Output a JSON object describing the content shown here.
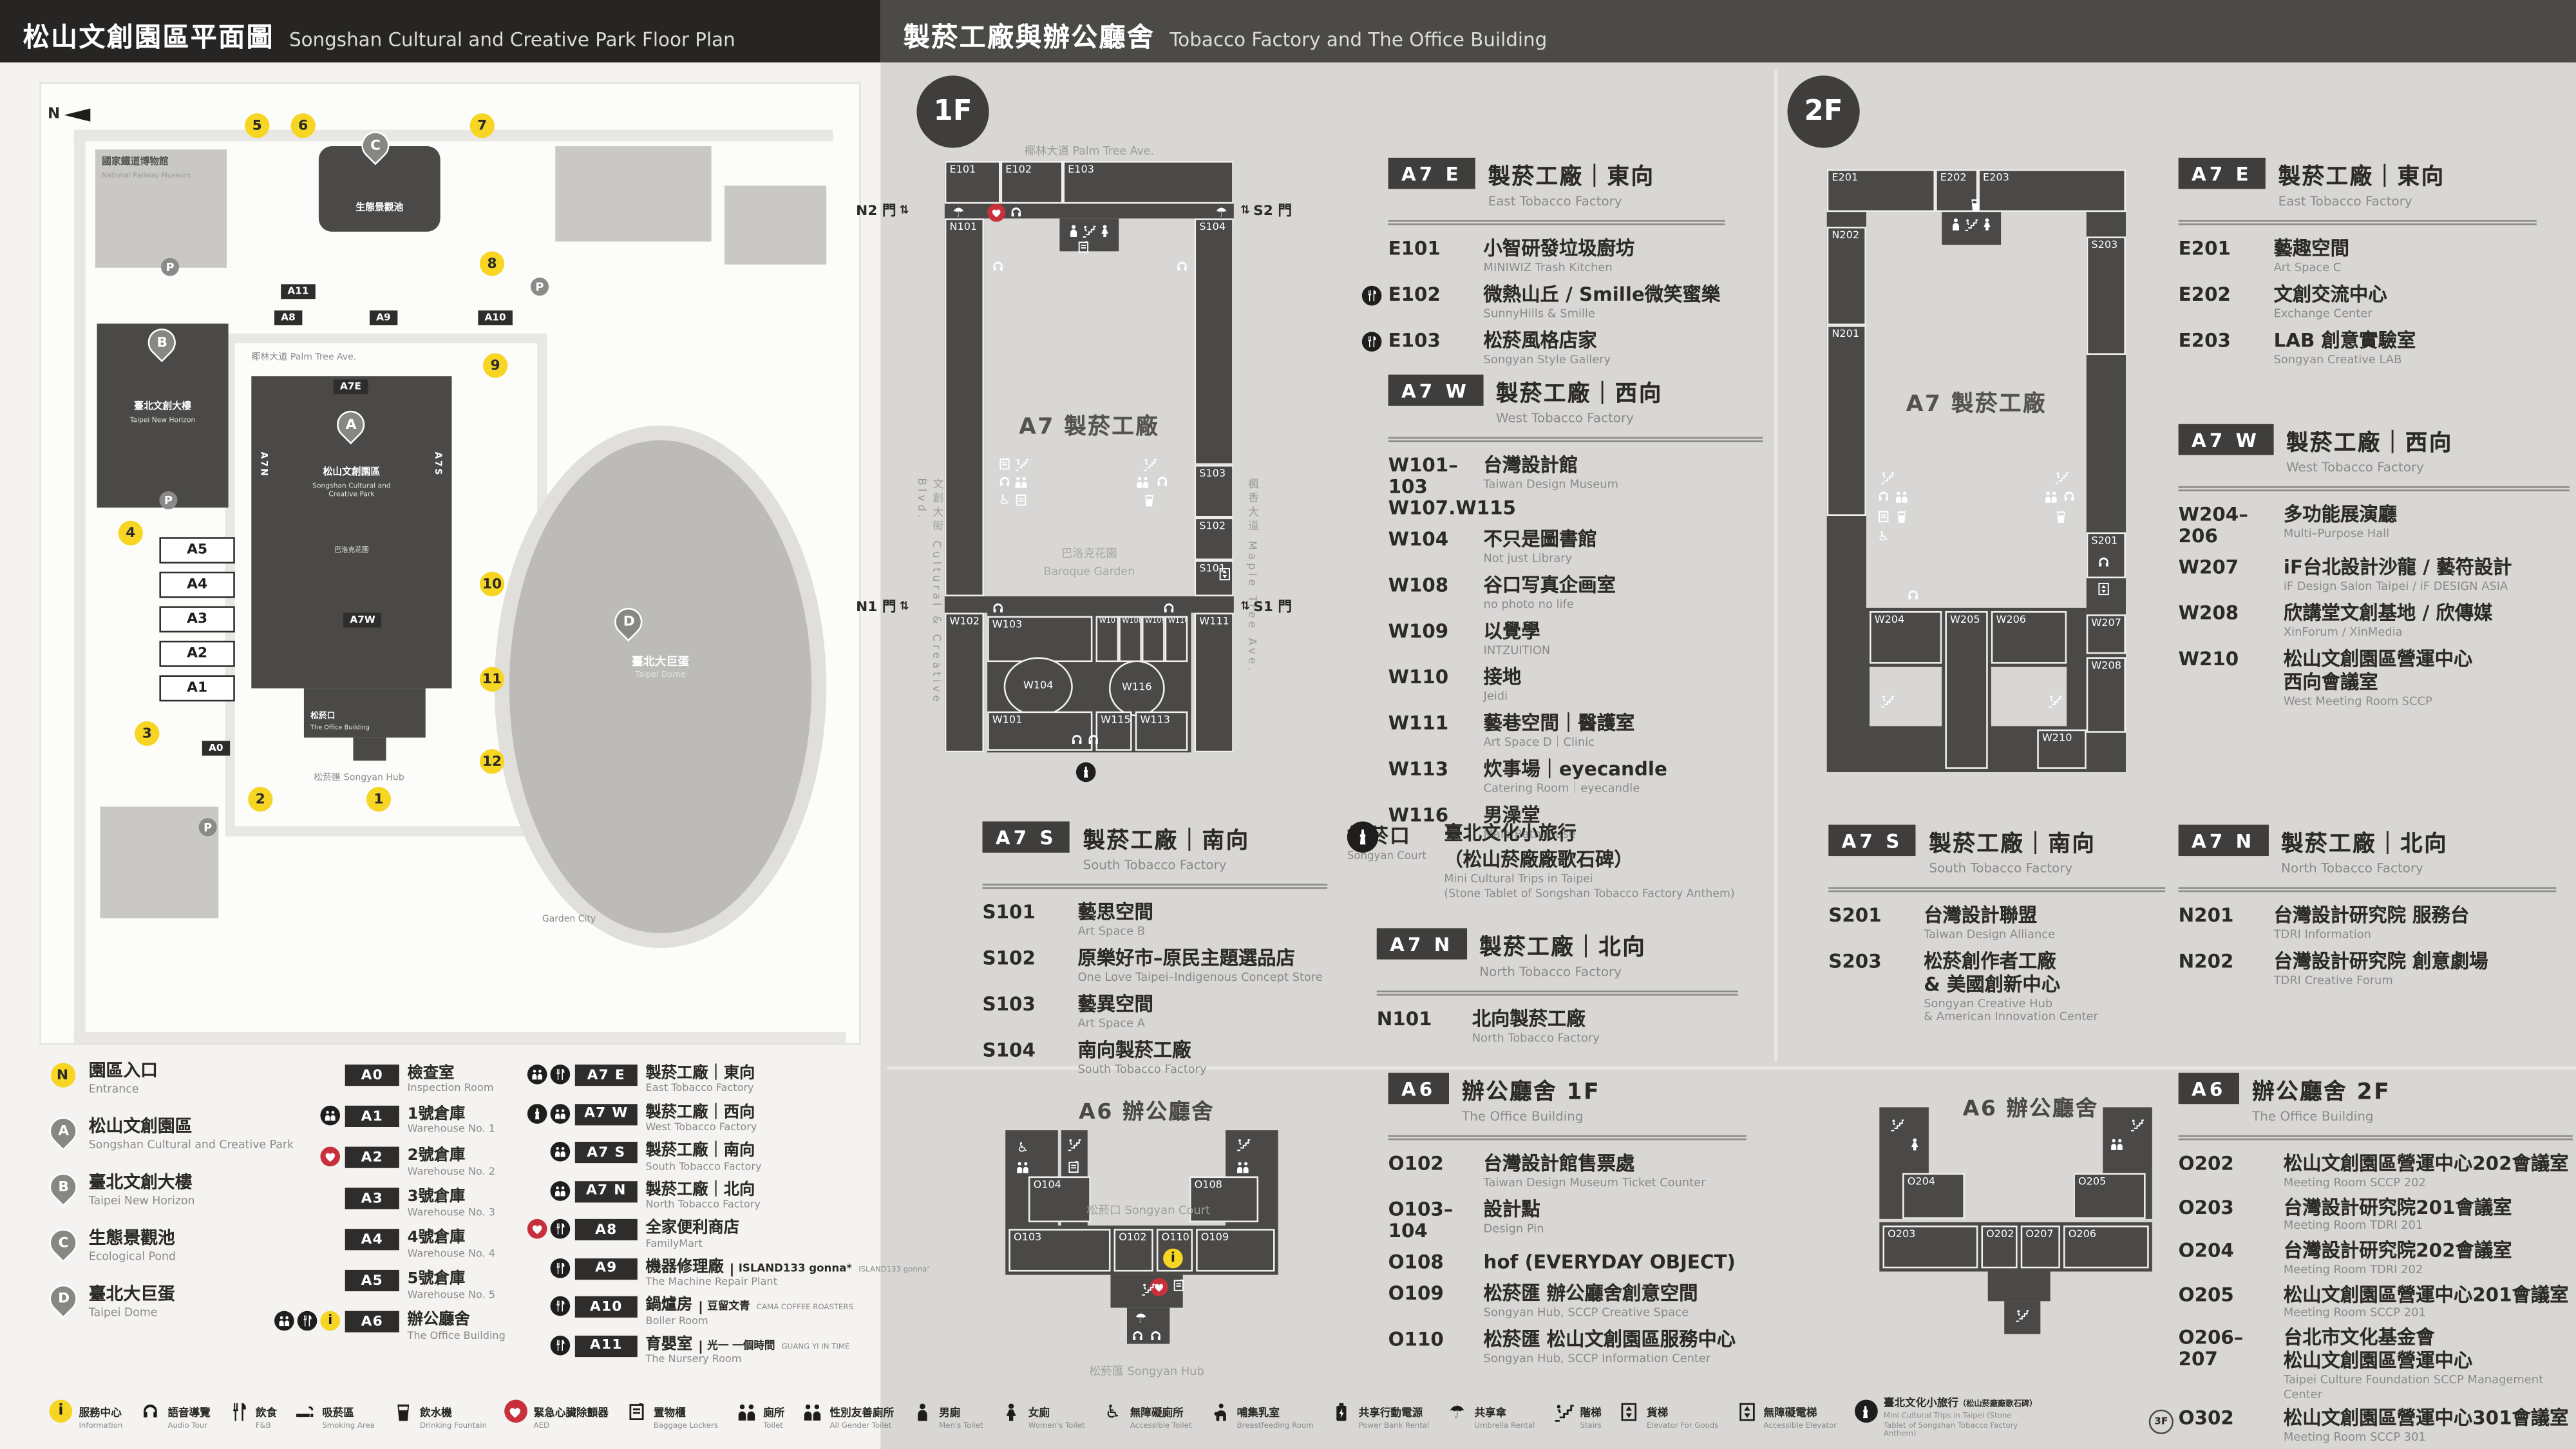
{
  "left": {
    "header": {
      "zh": "松山文創園區平面圖",
      "en": "Songshan Cultural and Creative Park Floor Plan"
    },
    "map": {
      "compass": "N",
      "palm_ave": "椰林大道 Palm Tree Ave.",
      "railway_museum": {
        "zh": "國家鐵道博物館",
        "en": "National Railway Museum"
      },
      "a_label": {
        "zh": "松山文創園區",
        "en1": "Songshan Cultural and",
        "en2": "Creative Park"
      },
      "a_sub": {
        "zh": "巴洛克花園"
      },
      "b_label": {
        "zh": "臺北文創大樓",
        "en": "Taipei New Horizon"
      },
      "c_label": {
        "zh": "生態景觀池"
      },
      "d_label": {
        "zh": "臺北大巨蛋",
        "en": "Taipei Dome"
      },
      "office": {
        "zh": "松菸口",
        "en": "The Office Building"
      },
      "hub": {
        "zh": "松菸匯",
        "en": "Songyan Hub"
      },
      "garden_city": "Garden City",
      "tags": {
        "a7e": "A7E",
        "a7w": "A7W",
        "a7n": "A7N",
        "a7s": "A7S",
        "a8": "A8",
        "a9": "A9",
        "a10": "A10",
        "a11": "A11",
        "a0": "A0"
      },
      "boxes": [
        {
          "code": "A5"
        },
        {
          "code": "A4"
        },
        {
          "code": "A3"
        },
        {
          "code": "A2"
        },
        {
          "code": "A1"
        }
      ],
      "entrances": [
        {
          "n": "1"
        },
        {
          "n": "2"
        },
        {
          "n": "3"
        },
        {
          "n": "4"
        },
        {
          "n": "5"
        },
        {
          "n": "6"
        },
        {
          "n": "7"
        },
        {
          "n": "8"
        },
        {
          "n": "9"
        },
        {
          "n": "10"
        },
        {
          "n": "11"
        },
        {
          "n": "12"
        }
      ],
      "parking_label": "P"
    },
    "legend": {
      "places": [
        {
          "marker": "N",
          "type": "entrance",
          "zh": "園區入口",
          "en": "Entrance"
        },
        {
          "marker": "A",
          "type": "pin",
          "zh": "松山文創園區",
          "en": "Songshan Cultural and Creative Park"
        },
        {
          "marker": "B",
          "type": "pin",
          "zh": "臺北文創大樓",
          "en": "Taipei New Horizon"
        },
        {
          "marker": "C",
          "type": "pin",
          "zh": "生態景觀池",
          "en": "Ecological Pond"
        },
        {
          "marker": "D",
          "type": "pin",
          "zh": "臺北大巨蛋",
          "en": "Taipei Dome"
        }
      ],
      "buildings": [
        {
          "code": "A0",
          "zh": "檢查室",
          "en": "Inspection Room",
          "icons": []
        },
        {
          "code": "A1",
          "zh": "1號倉庫",
          "en": "Warehouse No. 1",
          "icons": [
            "persons"
          ]
        },
        {
          "code": "A2",
          "zh": "2號倉庫",
          "en": "Warehouse No. 2",
          "icons": [
            "aed"
          ]
        },
        {
          "code": "A3",
          "zh": "3號倉庫",
          "en": "Warehouse No. 3",
          "icons": []
        },
        {
          "code": "A4",
          "zh": "4號倉庫",
          "en": "Warehouse No. 4",
          "icons": []
        },
        {
          "code": "A5",
          "zh": "5號倉庫",
          "en": "Warehouse No. 5",
          "icons": []
        },
        {
          "code": "A6",
          "zh": "辦公廳舍",
          "en": "The Office Building",
          "icons": [
            "persons",
            "food",
            "info"
          ]
        }
      ],
      "factories": [
        {
          "code": "A7 E",
          "zh": "製菸工廠｜東向",
          "en": "East Tobacco Factory",
          "icons": [
            "persons",
            "food"
          ]
        },
        {
          "code": "A7 W",
          "zh": "製菸工廠｜西向",
          "en": "West Tobacco Factory",
          "icons": [
            "tower",
            "persons"
          ]
        },
        {
          "code": "A7 S",
          "zh": "製菸工廠｜南向",
          "en": "South Tobacco Factory",
          "icons": [
            "persons"
          ]
        },
        {
          "code": "A7 N",
          "zh": "製菸工廠｜北向",
          "en": "North Tobacco Factory",
          "icons": [
            "persons"
          ]
        },
        {
          "code": "A8",
          "zh": "全家便利商店",
          "en": "FamilyMart",
          "icons": [
            "aed",
            "food"
          ]
        },
        {
          "code": "A9",
          "zh": "機器修理廠",
          "en": "The Machine Repair Plant",
          "note": "ISLAND133 gonna*",
          "note_en": "ISLAND133 gonna'",
          "icons": [
            "food"
          ]
        },
        {
          "code": "A10",
          "zh": "鍋爐房",
          "en": "Boiler Room",
          "note": "豆留文青",
          "note_en": "CAMA COFFEE ROASTERS",
          "icons": [
            "food"
          ]
        },
        {
          "code": "A11",
          "zh": "育嬰室",
          "en": "The Nursery Room",
          "note": "光一 一個時間",
          "note_en": "GUANG YI IN TIME",
          "icons": [
            "food"
          ]
        }
      ]
    }
  },
  "right": {
    "header": {
      "zh": "製菸工廠與辦公廳舍",
      "en": "Tobacco Factory and The Office Building"
    },
    "floor1": {
      "badge": "1F",
      "map": {
        "street_top": "椰林大道 Palm Tree Ave.",
        "street_left": "文創大街 Cultural & Creative Blvd.",
        "street_right": "楓香大道 Maple Tree Ave.",
        "label": "A7 製菸工廠",
        "garden_zh": "巴洛克花園",
        "garden_en": "Baroque Garden",
        "gates": {
          "n2": "N2 門",
          "s2": "S2 門",
          "n1": "N1 門",
          "s1": "S1 門"
        },
        "icon_names": [
          "umbrella",
          "aed",
          "headset",
          "persons",
          "person",
          "stairs",
          "locker",
          "elevator",
          "cup",
          "tower"
        ],
        "rooms": [
          {
            "code": "E101"
          },
          {
            "code": "E102"
          },
          {
            "code": "E103"
          },
          {
            "code": "N101"
          },
          {
            "code": "W102"
          },
          {
            "code": "S104"
          },
          {
            "code": "S103"
          },
          {
            "code": "S102"
          },
          {
            "code": "S101"
          },
          {
            "code": "W111"
          },
          {
            "code": "W103"
          },
          {
            "code": "W107"
          },
          {
            "code": "W108"
          },
          {
            "code": "W109"
          },
          {
            "code": "W110"
          },
          {
            "code": "W104"
          },
          {
            "code": "W116"
          },
          {
            "code": "W101"
          },
          {
            "code": "W115"
          },
          {
            "code": "W113"
          }
        ]
      },
      "sections": {
        "e": {
          "tag": "A7 E",
          "zh": "製菸工廠｜東向",
          "en": "East Tobacco Factory",
          "rooms": [
            {
              "code": "E101",
              "zh": "小智研發垃圾廚坊",
              "en": "MINIWIZ Trash Kitchen"
            },
            {
              "code": "E102",
              "zh": "微熱山丘 / Smille微笑蜜樂",
              "en": "SunnyHills & Smille",
              "icons": [
                "food"
              ]
            },
            {
              "code": "E103",
              "zh": "松菸風格店家",
              "en": "Songyan Style Gallery",
              "icons": [
                "food"
              ]
            }
          ]
        },
        "w": {
          "tag": "A7 W",
          "zh": "製菸工廠｜西向",
          "en": "West Tobacco Factory",
          "rooms": [
            {
              "code": "W101–103",
              "code2": "W107.W115",
              "zh": "台灣設計館",
              "en": "Taiwan Design Museum"
            },
            {
              "code": "W104",
              "zh": "不只是圖書館",
              "en": "Not just Library"
            },
            {
              "code": "W108",
              "zh": "谷口写真企画室",
              "en": "no photo no life"
            },
            {
              "code": "W109",
              "zh": "以覺學",
              "en": "INTZUITION"
            },
            {
              "code": "W110",
              "zh": "接地",
              "en": "Jeidi"
            },
            {
              "code": "W111",
              "zh": "藝巷空間｜醫護室",
              "en": "Art Space D｜Clinic"
            },
            {
              "code": "W113",
              "zh": "炊事場｜eyecandle",
              "en": "Catering Room｜eyecandle"
            },
            {
              "code": "W116",
              "zh": "男澡堂",
              "en": "Male Bathhouse"
            }
          ]
        },
        "s": {
          "tag": "A7 S",
          "zh": "製菸工廠｜南向",
          "en": "South Tobacco Factory",
          "rooms": [
            {
              "code": "S101",
              "zh": "藝思空間",
              "en": "Art Space B"
            },
            {
              "code": "S102",
              "zh": "原樂好市–原民主題選品店",
              "en": "One Love Taipei–Indigenous Concept Store"
            },
            {
              "code": "S103",
              "zh": "藝異空間",
              "en": "Art Space A"
            },
            {
              "code": "S104",
              "zh": "南向製菸工廠",
              "en": "South Tobacco Factory"
            }
          ]
        },
        "n": {
          "tag": "A7 N",
          "zh": "製菸工廠｜北向",
          "en": "North Tobacco Factory",
          "rooms": [
            {
              "code": "N101",
              "zh": "北向製菸工廠",
              "en": "North Tobacco Factory"
            }
          ]
        },
        "songyan": {
          "zh": "松菸口",
          "en": "Songyan Court",
          "t1": "臺北文化小旅行",
          "t2": "（松山菸廠廠歌石碑）",
          "e1": "Mini Cultural Trips in Taipei",
          "e2": "(Stone Tablet of Songshan Tobacco Factory Anthem)"
        }
      },
      "office": {
        "tag": "A6",
        "zh": "辦公廳舍 1F",
        "en": "The Office Building",
        "map_title": "A6 辦公廳舍",
        "court": "松菸口 Songyan Court",
        "hub": "松菸匯 Songyan Hub",
        "map_rooms": [
          {
            "code": "O104"
          },
          {
            "code": "O108"
          },
          {
            "code": "O103"
          },
          {
            "code": "O102"
          },
          {
            "code": "O110"
          },
          {
            "code": "O109"
          }
        ],
        "rooms": [
          {
            "code": "O102",
            "zh": "台灣設計館售票處",
            "en": "Taiwan Design Museum Ticket Counter"
          },
          {
            "code": "O103–104",
            "zh": "設計點",
            "en": "Design Pin"
          },
          {
            "code": "O108",
            "zh": "hof (EVERYDAY OBJECT)"
          },
          {
            "code": "O109",
            "zh": "松菸匯 辦公廳舍創意空間",
            "en": "Songyan Hub, SCCP Creative Space"
          },
          {
            "code": "O110",
            "zh": "松菸匯 松山文創園區服務中心",
            "en": "Songyan Hub, SCCP Information Center"
          }
        ]
      }
    },
    "floor2": {
      "badge": "2F",
      "map": {
        "label": "A7 製菸工廠",
        "icon_names": [
          "persons",
          "person",
          "stairs",
          "headset",
          "elevator",
          "cup",
          "wheelchair",
          "locker"
        ],
        "rooms": [
          {
            "code": "E201"
          },
          {
            "code": "E202"
          },
          {
            "code": "E203"
          },
          {
            "code": "N202"
          },
          {
            "code": "N201"
          },
          {
            "code": "S203"
          },
          {
            "code": "S201"
          },
          {
            "code": "W204"
          },
          {
            "code": "W205"
          },
          {
            "code": "W206"
          },
          {
            "code": "W207"
          },
          {
            "code": "W208"
          },
          {
            "code": "W210"
          }
        ]
      },
      "sections": {
        "e": {
          "tag": "A7 E",
          "zh": "製菸工廠｜東向",
          "en": "East Tobacco Factory",
          "rooms": [
            {
              "code": "E201",
              "zh": "藝趣空間",
              "en": "Art Space C"
            },
            {
              "code": "E202",
              "zh": "文創交流中心",
              "en": "Exchange Center"
            },
            {
              "code": "E203",
              "zh": "LAB 創意實驗室",
              "en": "Songyan Creative LAB"
            }
          ]
        },
        "w": {
          "tag": "A7 W",
          "zh": "製菸工廠｜西向",
          "en": "West Tobacco Factory",
          "rooms": [
            {
              "code": "W204–206",
              "zh": "多功能展演廳",
              "en": "Multi–Purpose Hall"
            },
            {
              "code": "W207",
              "zh": "iF台北設計沙龍 / 藝符設計",
              "en": "iF Design Salon Taipei / iF DESIGN ASIA"
            },
            {
              "code": "W208",
              "zh": "欣講堂文創基地 / 欣傳媒",
              "en": "XinForum / XinMedia"
            },
            {
              "code": "W210",
              "zh": "松山文創園區營運中心",
              "zh2": "西向會議室",
              "en": "West Meeting Room SCCP"
            }
          ]
        },
        "s": {
          "tag": "A7 S",
          "zh": "製菸工廠｜南向",
          "en": "South Tobacco Factory",
          "rooms": [
            {
              "code": "S201",
              "zh": "台灣設計聯盟",
              "en": "Taiwan Design Alliance"
            },
            {
              "code": "S203",
              "zh": "松菸創作者工廠",
              "zh2": "& 美國創新中心",
              "en": "Songyan Creative Hub",
              "en2": "& American Innovation Center"
            }
          ]
        },
        "n": {
          "tag": "A7 N",
          "zh": "製菸工廠｜北向",
          "en": "North Tobacco Factory",
          "rooms": [
            {
              "code": "N201",
              "zh": "台灣設計研究院 服務台",
              "en": "TDRI Information"
            },
            {
              "code": "N202",
              "zh": "台灣設計研究院 創意劇場",
              "en": "TDRI Creative Forum"
            }
          ]
        }
      },
      "office": {
        "tag": "A6",
        "zh": "辦公廳舍 2F",
        "en": "The Office Building",
        "map_title": "A6 辦公廳舍",
        "map_rooms": [
          {
            "code": "O204"
          },
          {
            "code": "O205"
          },
          {
            "code": "O203"
          },
          {
            "code": "O202"
          },
          {
            "code": "O207"
          },
          {
            "code": "O206"
          }
        ],
        "rooms": [
          {
            "code": "O202",
            "zh": "松山文創園區營運中心202會議室",
            "en": "Meeting Room SCCP 202"
          },
          {
            "code": "O203",
            "zh": "台灣設計研究院201會議室",
            "en": "Meeting Room TDRI 201"
          },
          {
            "code": "O204",
            "zh": "台灣設計研究院202會議室",
            "en": "Meeting Room TDRI 202"
          },
          {
            "code": "O205",
            "zh": "松山文創園區營運中心201會議室",
            "en": "Meeting Room SCCP 201"
          },
          {
            "code": "O206–207",
            "zh": "台北市文化基金會",
            "zh2": "松山文創園區營運中心",
            "en": "Taipei Culture Foundation SCCP Management Center"
          },
          {
            "code": "O302",
            "prefix": "3F",
            "zh": "松山文創園區營運中心301會議室",
            "en": "Meeting Room SCCP 301"
          }
        ]
      }
    }
  },
  "footer": {
    "items": [
      {
        "icon": "info",
        "zh": "服務中心",
        "en": "Information"
      },
      {
        "icon": "headset",
        "zh": "語音導覽",
        "en": "Audio Tour"
      },
      {
        "icon": "food",
        "zh": "飲食",
        "en": "F&B"
      },
      {
        "icon": "smoke",
        "zh": "吸菸區",
        "en": "Smoking Area"
      },
      {
        "icon": "cup",
        "zh": "飲水機",
        "en": "Drinking Fountain"
      },
      {
        "icon": "aed",
        "zh": "緊急心臟除顫器",
        "en": "AED"
      },
      {
        "icon": "locker",
        "zh": "置物櫃",
        "en": "Baggage Lockers"
      },
      {
        "icon": "persons",
        "zh": "廁所",
        "en": "Toilet"
      },
      {
        "icon": "persons",
        "zh": "性別友善廁所",
        "en": "All Gender Toilet"
      },
      {
        "icon": "person",
        "zh": "男廁",
        "en": "Men's Toilet"
      },
      {
        "icon": "female",
        "zh": "女廁",
        "en": "Women's Toilet"
      },
      {
        "icon": "wheelchair",
        "zh": "無障礙廁所",
        "en": "Accessible Toilet"
      },
      {
        "icon": "breastfeed",
        "zh": "哺集乳室",
        "en": "Breastfeeding Room"
      },
      {
        "icon": "power",
        "zh": "共享行動電源",
        "en": "Power Bank Rental"
      },
      {
        "icon": "umbrella",
        "zh": "共享傘",
        "en": "Umbrella Rental"
      },
      {
        "icon": "stairs",
        "zh": "階梯",
        "en": "Stairs"
      },
      {
        "icon": "elevator",
        "zh": "貨梯",
        "en": "Elevator For Goods"
      },
      {
        "icon": "elevator",
        "zh": "無障礙電梯",
        "en": "Accessible Elevator"
      },
      {
        "icon": "tower",
        "zh": "臺北文化小旅行",
        "note": "（松山菸廠廠歌石碑）",
        "en": "Mini Cultural Trips in Taipei (Stone Tablet of Songshan Tobacco Factory Anthem)",
        "wide": true
      }
    ]
  }
}
